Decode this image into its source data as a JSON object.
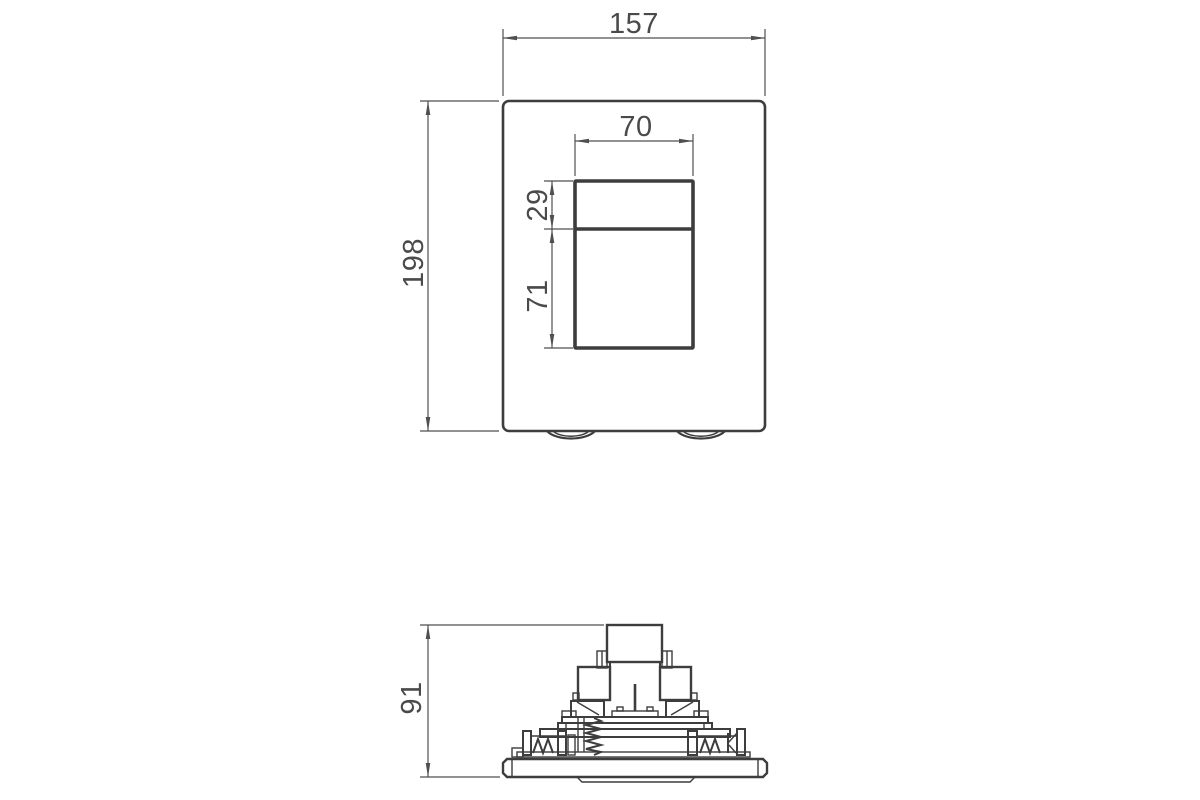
{
  "app": {
    "title": "Flush plate technical dimension drawing"
  },
  "drawing": {
    "colors": {
      "line": "#3d3d3d",
      "dimension": "#4f4f4f",
      "text": "#4a4a4a",
      "background": "#ffffff"
    },
    "front_view": {
      "name": "flush-plate-front-view",
      "dimensions": {
        "overall_width": "157",
        "overall_height": "198",
        "button_cutout_width": "70",
        "small_button_height": "29",
        "large_button_height": "71"
      }
    },
    "side_view": {
      "name": "flush-plate-side-view-mechanism",
      "dimensions": {
        "overall_depth": "91"
      }
    }
  }
}
